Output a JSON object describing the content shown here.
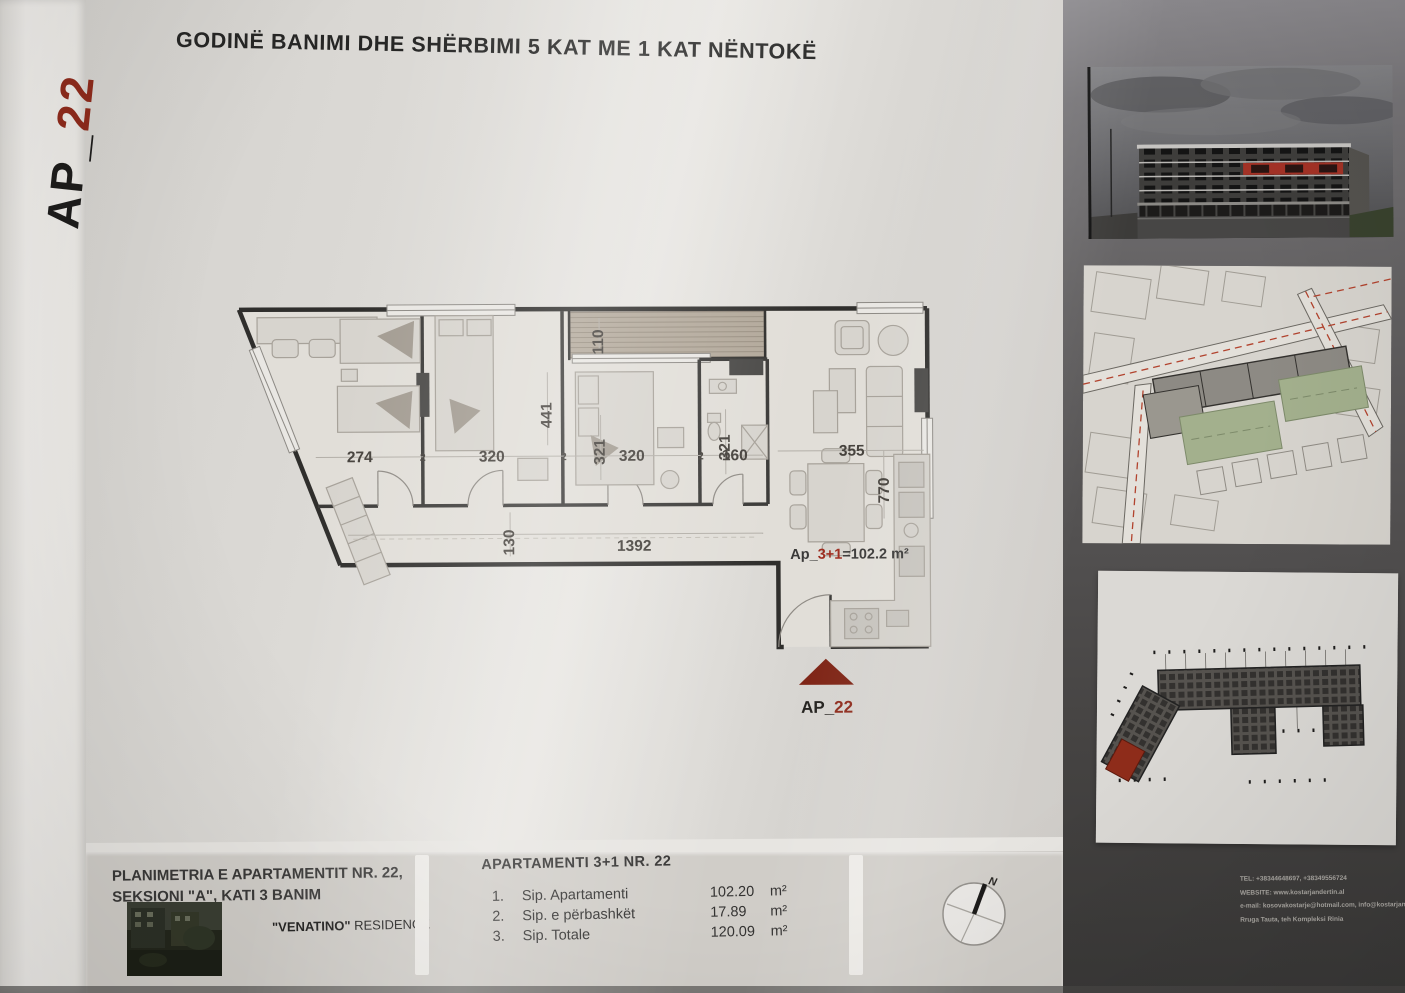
{
  "sheet": {
    "code_prefix": "AP_",
    "code_number": "22",
    "title": "GODINË BANIMI DHE SHËRBIMI 5 KAT ME 1 KAT NËNTOKË"
  },
  "plan": {
    "dims": {
      "d274": "274",
      "d320a": "320",
      "d320b": "320",
      "d160": "160",
      "d355": "355",
      "d441": "441",
      "d321a": "321",
      "d321b": "321",
      "d770": "770",
      "d130": "130",
      "d1392": "1392",
      "d110": "110",
      "w2a": "2",
      "w2b": "2",
      "w2c": "2"
    },
    "area_label": {
      "prefix": "Ap_",
      "red": "3+1",
      "suffix": "=102.2 m²"
    },
    "marker": {
      "prefix": "AP_",
      "number": "22"
    }
  },
  "titleblock": {
    "left_line1": "PLANIMETRIA E APARTAMENTIT NR. 22,",
    "left_line2": "SEKSIONI \"A\", KATI 3 BANIM",
    "residence_name": "\"VENATINO\"",
    "residence_word": " RESIDENCE",
    "table_title": "APARTAMENTI 3+1  NR. 22",
    "rows": [
      {
        "no": "1.",
        "label": "Sip. Apartamenti",
        "value": "102.20",
        "unit": "m²"
      },
      {
        "no": "2.",
        "label": "Sip. e përbashkët",
        "value": "17.89",
        "unit": "m²"
      },
      {
        "no": "3.",
        "label": "Sip. Totale",
        "value": "120.09",
        "unit": "m²"
      }
    ],
    "compass_n": "N"
  },
  "sidebar": {
    "contact": {
      "tel": "TEL: +38344648697, +38349556724",
      "website": "WEBSITE: www.kostarjandertin.al",
      "email": "e-mail: kosovakostarje@hotmail.com, info@kostarjandertin.al",
      "address": "Rruga Tauta, teh Kompleksi Rinia"
    }
  },
  "colors": {
    "accent_red": "#9e2b1e",
    "marker_red": "#7e2415"
  }
}
